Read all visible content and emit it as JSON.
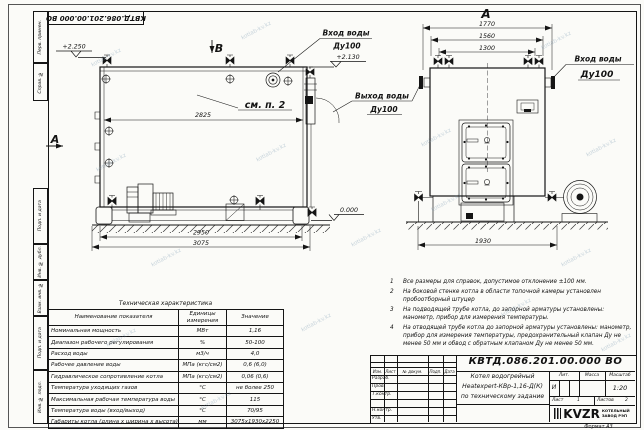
{
  "sheet": {
    "stamp_top": "КВТД.086.201.00.000  ВО",
    "margin": {
      "perv": "Перв. примен.",
      "sprav": "Справ. №",
      "podp1": "Подп. и дата",
      "inv_dubl": "Инв. № дубл.",
      "vzam": "Взам. инв. №",
      "podp2": "Подп. и дата",
      "inv_podl": "Инв. № подл."
    },
    "format_label": "Формат  А3",
    "watermark": "kotlab-kv.kz"
  },
  "views": {
    "side": {
      "marker_b": "В",
      "marker_a": "А",
      "callout": "см. п. 2",
      "level_top": "+2.250",
      "level_inlet": "+2.130",
      "level_ground": "0.000",
      "dim_2825": "2825",
      "dim_2950": "2950",
      "dim_3075": "3075",
      "inlet_label1": "Вход воды",
      "inlet_label2": "Ду100",
      "outlet_label1": "Выход воды",
      "outlet_label2": "Ду100"
    },
    "front": {
      "title": "А",
      "dim_1770": "1770",
      "dim_1560": "1560",
      "dim_1300": "1300",
      "dim_1930": "1930",
      "inlet_label1": "Вход воды",
      "inlet_label2": "Ду100"
    }
  },
  "tech_table": {
    "title": "Техническая характеристика",
    "headers": [
      "Наименование показателя",
      "Единицы измерения",
      "Значение"
    ],
    "rows": [
      {
        "name": "Номинальная мощность",
        "unit": "МВт",
        "value": "1,16"
      },
      {
        "name": "Диапазон рабочего регулирования",
        "unit": "%",
        "value": "50-100"
      },
      {
        "name": "Расход воды",
        "unit": "м3/ч",
        "value": "4,0"
      },
      {
        "name": "Рабочее давление воды",
        "unit": "МПа (кгс/см2)",
        "value": "0,6 (6,0)"
      },
      {
        "name": "Гидравлическое сопротивление котла",
        "unit": "МПа (кгс/см2)",
        "value": "0,06 (0,6)"
      },
      {
        "name": "Температура уходящих газов",
        "unit": "°С",
        "value": "не более 250"
      },
      {
        "name": "Максимальная рабочая температура воды",
        "unit": "°С",
        "value": "115"
      },
      {
        "name": "Температура воды (вход/выход)",
        "unit": "°С",
        "value": "70/95"
      },
      {
        "name": "Габариты котла (длина х ширина х высота)",
        "unit": "мм",
        "value": "3075х1930х2250"
      }
    ]
  },
  "notes": [
    {
      "n": "1",
      "text": "Все размеры для справок, допустимое отклонение ±100 мм."
    },
    {
      "n": "2",
      "text": "На боковой стенке котла в области топочной камеры установлен пробоотборный штуцер"
    },
    {
      "n": "3",
      "text": "На подводящей трубе котла, до запорной арматуры установлены: манометр, прибор для измерения температуры."
    },
    {
      "n": "4",
      "text": "На отводящей трубе котла до запорной арматуры установлены: манометр, прибор для измерения температуры, предохранительный клапан Ду не менее 50 мм и обвод с обратным клапаном Ду не менее 50 мм."
    }
  ],
  "title_block": {
    "doc_number": "КВТД.086.201.00.000  ВО",
    "name_line1": "Котел водогрейный",
    "name_line2": "Heatexpert-КВр-1,16-Д(К)",
    "name_line3": "по техническому задание",
    "lit_header": "Лит.",
    "mass_header": "Масса",
    "scale_header": "Масштаб",
    "lit_value": "И",
    "scale_value": "1:20",
    "sheet_label": "Лист",
    "sheet_value": "1",
    "sheets_label": "Листов",
    "sheets_value": "2",
    "cols": [
      "Изм.",
      "Лист",
      "№ докум.",
      "Подп.",
      "Дата"
    ],
    "rows": [
      "Разраб.",
      "Пров.",
      "Т.контр.",
      "",
      "Н.контр.",
      "Утв."
    ],
    "logo": "KVZR",
    "logo_sub1": "КОТЕЛЬНЫЙ",
    "logo_sub2": "ЗАВОД РЭП"
  }
}
